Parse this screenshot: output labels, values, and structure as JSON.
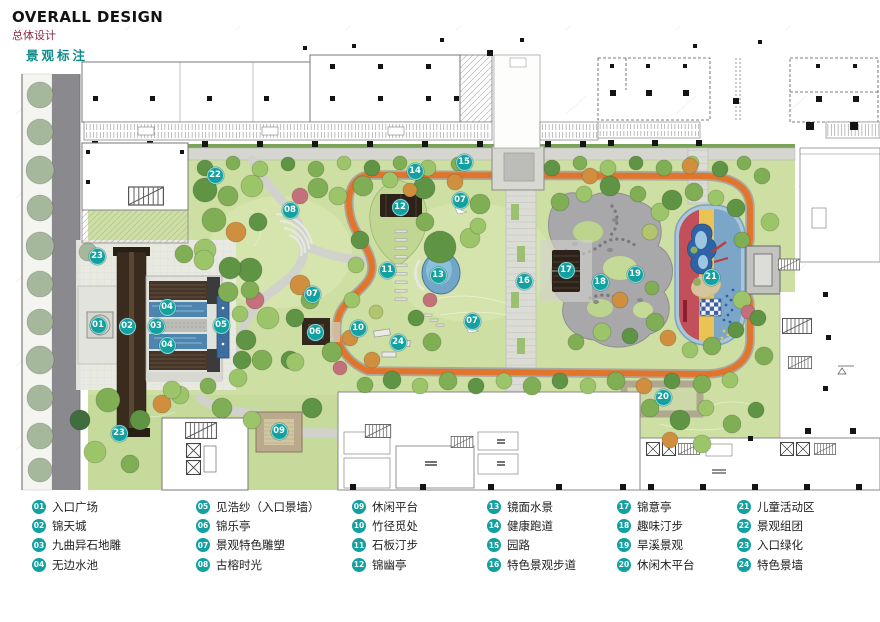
{
  "header": {
    "title": "OVERALL DESIGN",
    "subtitle": "总体设计",
    "section_label": "景观标注"
  },
  "colors": {
    "badge_teal": "#12a0a0",
    "track_orange": "#e2752c",
    "subtitle_maroon": "#8b2a44",
    "section_teal": "#0d8a8a"
  },
  "plan": {
    "markers": [
      {
        "num": "01",
        "label": "入口广场",
        "x": 98,
        "y": 325
      },
      {
        "num": "02",
        "label": "锦天城",
        "x": 127,
        "y": 326
      },
      {
        "num": "03",
        "label": "九曲异石地雕",
        "x": 156,
        "y": 326
      },
      {
        "num": "04",
        "label": "无边水池",
        "x": 167,
        "y": 307
      },
      {
        "num": "04",
        "label": "无边水池",
        "x": 167,
        "y": 345
      },
      {
        "num": "05",
        "label": "见浩纱（入口景墙）",
        "x": 221,
        "y": 325
      },
      {
        "num": "06",
        "label": "锦乐亭",
        "x": 315,
        "y": 332
      },
      {
        "num": "07",
        "label": "景观特色雕塑",
        "x": 460,
        "y": 200
      },
      {
        "num": "07",
        "label": "景观特色雕塑",
        "x": 312,
        "y": 294
      },
      {
        "num": "07",
        "label": "景观特色雕塑",
        "x": 472,
        "y": 321
      },
      {
        "num": "08",
        "label": "古榕时光",
        "x": 290,
        "y": 210
      },
      {
        "num": "09",
        "label": "休闲平台",
        "x": 279,
        "y": 431
      },
      {
        "num": "10",
        "label": "竹径觅处",
        "x": 358,
        "y": 328
      },
      {
        "num": "11",
        "label": "石板汀步",
        "x": 387,
        "y": 270
      },
      {
        "num": "12",
        "label": "锦幽亭",
        "x": 400,
        "y": 207
      },
      {
        "num": "13",
        "label": "镜面水景",
        "x": 438,
        "y": 275
      },
      {
        "num": "14",
        "label": "健康跑道",
        "x": 415,
        "y": 171
      },
      {
        "num": "15",
        "label": "园路",
        "x": 464,
        "y": 162
      },
      {
        "num": "16",
        "label": "特色景观步道",
        "x": 524,
        "y": 281
      },
      {
        "num": "17",
        "label": "锦意亭",
        "x": 566,
        "y": 270
      },
      {
        "num": "18",
        "label": "趣味汀步",
        "x": 600,
        "y": 282
      },
      {
        "num": "19",
        "label": "旱溪景观",
        "x": 635,
        "y": 274
      },
      {
        "num": "20",
        "label": "休闲木平台",
        "x": 663,
        "y": 397
      },
      {
        "num": "21",
        "label": "儿童活动区",
        "x": 711,
        "y": 277
      },
      {
        "num": "22",
        "label": "景观组团",
        "x": 215,
        "y": 175
      },
      {
        "num": "23",
        "label": "入口绿化",
        "x": 97,
        "y": 256
      },
      {
        "num": "23",
        "label": "入口绿化",
        "x": 119,
        "y": 433
      },
      {
        "num": "24",
        "label": "特色景墙",
        "x": 398,
        "y": 342
      }
    ]
  },
  "legend": {
    "columns": [
      [
        {
          "num": "01",
          "label": "入口广场"
        },
        {
          "num": "02",
          "label": "锦天城"
        },
        {
          "num": "03",
          "label": "九曲异石地雕"
        },
        {
          "num": "04",
          "label": "无边水池"
        }
      ],
      [
        {
          "num": "05",
          "label": "见浩纱（入口景墙）"
        },
        {
          "num": "06",
          "label": "锦乐亭"
        },
        {
          "num": "07",
          "label": "景观特色雕塑"
        },
        {
          "num": "08",
          "label": "古榕时光"
        }
      ],
      [
        {
          "num": "09",
          "label": "休闲平台"
        },
        {
          "num": "10",
          "label": "竹径觅处"
        },
        {
          "num": "11",
          "label": "石板汀步"
        },
        {
          "num": "12",
          "label": "锦幽亭"
        }
      ],
      [
        {
          "num": "13",
          "label": "镜面水景"
        },
        {
          "num": "14",
          "label": "健康跑道"
        },
        {
          "num": "15",
          "label": "园路"
        },
        {
          "num": "16",
          "label": "特色景观步道"
        }
      ],
      [
        {
          "num": "17",
          "label": "锦意亭"
        },
        {
          "num": "18",
          "label": "趣味汀步"
        },
        {
          "num": "19",
          "label": "旱溪景观"
        },
        {
          "num": "20",
          "label": "休闲木平台"
        }
      ],
      [
        {
          "num": "21",
          "label": "儿童活动区"
        },
        {
          "num": "22",
          "label": "景观组团"
        },
        {
          "num": "23",
          "label": "入口绿化"
        },
        {
          "num": "24",
          "label": "特色景墙"
        }
      ]
    ]
  }
}
